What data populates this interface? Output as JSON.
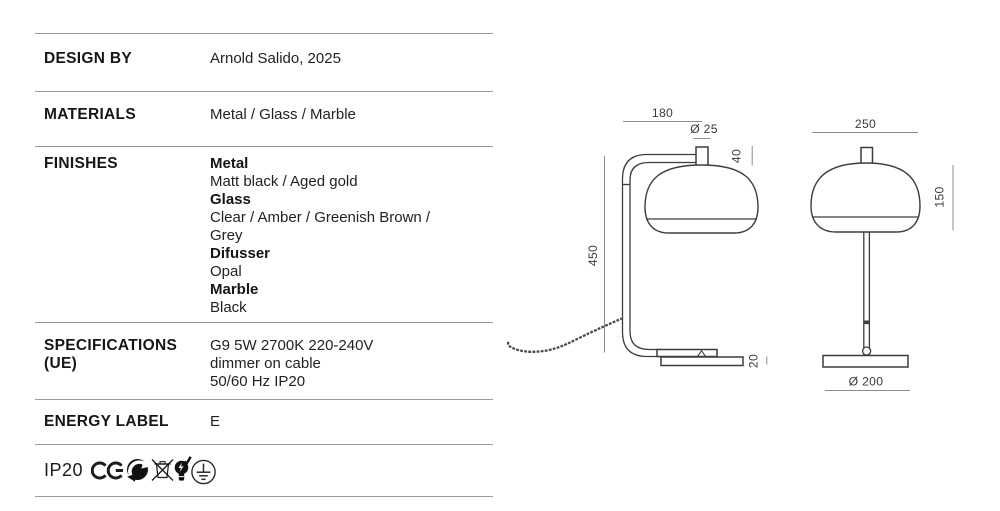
{
  "table": {
    "design_by": {
      "label": "DESIGN BY",
      "value": "Arnold Salido, 2025"
    },
    "materials": {
      "label": "MATERIALS",
      "value": "Metal / Glass / Marble"
    },
    "finishes": {
      "label": "FINISHES",
      "lines": [
        {
          "style": "bold",
          "text": "Metal"
        },
        {
          "style": "regular",
          "text": "Matt black / Aged gold"
        },
        {
          "style": "bold",
          "text": "Glass"
        },
        {
          "style": "regular",
          "text": "Clear / Amber / Greenish Brown /"
        },
        {
          "style": "regular",
          "text": "Grey"
        },
        {
          "style": "bold",
          "text": "Difusser"
        },
        {
          "style": "regular",
          "text": "Opal"
        },
        {
          "style": "bold",
          "text": "Marble"
        },
        {
          "style": "regular",
          "text": "Black"
        }
      ]
    },
    "specifications": {
      "label_line1": "SPECIFICATIONS",
      "label_line2": "(UE)",
      "line1": "G9 5W 2700K 220-240V",
      "line2": "dimmer on cable",
      "line3": "50/60 Hz IP20"
    },
    "energy": {
      "label": "ENERGY LABEL",
      "value": "E"
    }
  },
  "certifications": {
    "ip_rating": "IP20",
    "icons": [
      "ce-mark-icon",
      "green-dot-recycling-icon",
      "weee-crossed-bin-icon",
      "bulb-check-icon",
      "protective-earth-icon"
    ]
  },
  "drawings": {
    "side_view": {
      "width": "180",
      "tube_diameter": "Ø 25",
      "cap_height": "40",
      "total_height": "450",
      "base_thickness": "20"
    },
    "front_view": {
      "shade_width": "250",
      "shade_height": "150",
      "base_diameter": "Ø 200"
    }
  },
  "colors": {
    "text": "#1a1a1a",
    "rule_line": "#9b9b9b",
    "drawing_line": "#3d3d3d",
    "dimension_line": "#8c8c8c"
  }
}
